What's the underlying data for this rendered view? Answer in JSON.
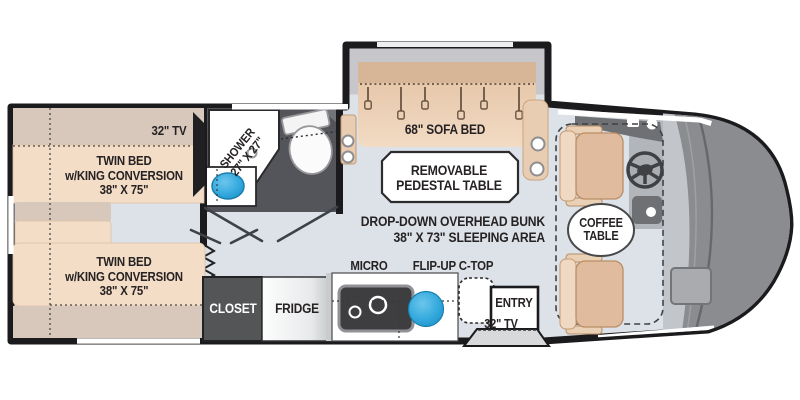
{
  "colors": {
    "wall": "#1b1b1d",
    "floor": "#dce2e8",
    "slide_gray": "#c7c6ca",
    "tan_light": "#f3ddc6",
    "tan_mid": "#e6c6a9",
    "tan_dark": "#d8c8bb",
    "sofa_top": "#d7b697",
    "sofa_body": "#eed3b9",
    "dark_room": "#54555a",
    "closet_dark": "#545557",
    "accent_blue": "#35aade",
    "cab_gray": "#c2c5c9",
    "nose_gray": "#8a8c90",
    "dash_gray": "#6e7074",
    "step_gray": "#d8d9db",
    "text": "#262223",
    "white": "#ffffff"
  },
  "labels": {
    "bedroom_tv": "32\" TV",
    "bed_front": {
      "line1": "TWIN BED",
      "line2": "w/KING CONVERSION",
      "line3": "38\" X 75\""
    },
    "bed_rear": {
      "line1": "TWIN BED",
      "line2": "w/KING CONVERSION",
      "line3": "38\" X 75\""
    },
    "shower": {
      "line1": "SHOWER",
      "line2": "27\" X 27\""
    },
    "sofa_bed": "68\" SOFA BED",
    "pedestal_table": {
      "line1": "REMOVABLE",
      "line2": "PEDESTAL TABLE"
    },
    "overhead_bunk": {
      "line1": "DROP-DOWN OVERHEAD BUNK",
      "line2": "38\" X 73\" SLEEPING AREA"
    },
    "micro": "MICRO",
    "flip_up_ctop": "FLIP-UP C-TOP",
    "closet": "CLOSET",
    "fridge": "FRIDGE",
    "entry": "ENTRY",
    "entry_tv": "32\" TV",
    "coffee_table": {
      "line1": "COFFEE",
      "line2": "TABLE"
    }
  }
}
